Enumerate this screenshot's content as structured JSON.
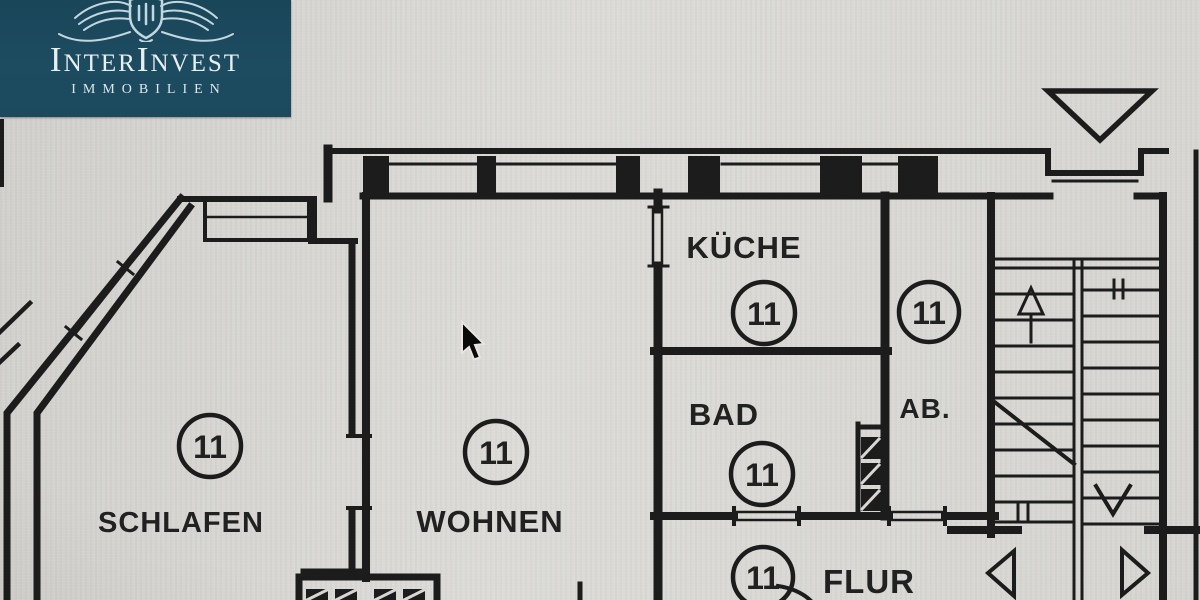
{
  "brand": {
    "name": "InterInvest",
    "subtitle": "IMMOBILIEN",
    "emblem": "winged-crest",
    "background_color": "#1d4b60",
    "text_color": "#e9eff1"
  },
  "floorplan": {
    "unit_number": "11",
    "rooms": [
      {
        "id": "schlafen",
        "label": "SCHLAFEN",
        "number": "11"
      },
      {
        "id": "wohnen",
        "label": "WOHNEN",
        "number": "11"
      },
      {
        "id": "kueche",
        "label": "KÜCHE",
        "number": "11"
      },
      {
        "id": "bad",
        "label": "BAD",
        "number": "11"
      },
      {
        "id": "ab",
        "label": "AB.",
        "number": "11"
      },
      {
        "id": "flur",
        "label": "FLUR",
        "number": "11"
      }
    ],
    "features": [
      "stairwell",
      "entrance-triangle-marker",
      "shaft-hatched-squares",
      "balcony-strip"
    ],
    "ink_color": "#1c1c1c",
    "paper_color": "#d8d7d3"
  },
  "cursor": {
    "visible": true
  }
}
